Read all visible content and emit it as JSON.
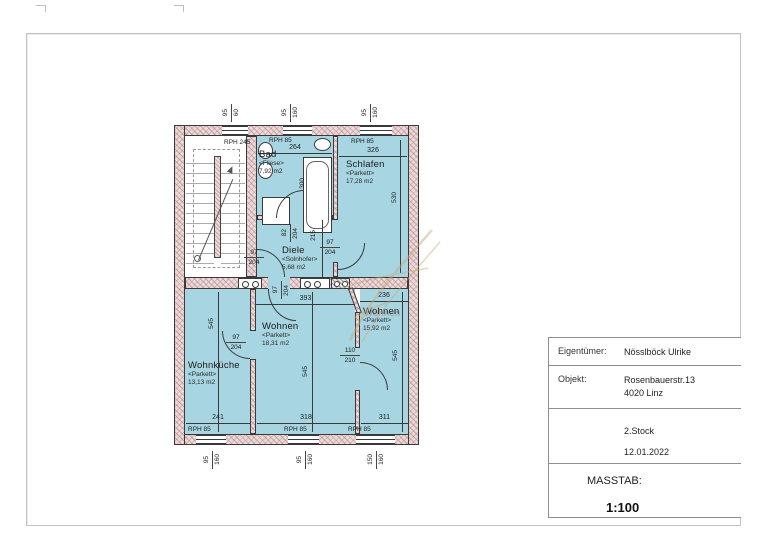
{
  "plan": {
    "rooms": {
      "bad": {
        "name": "Bad",
        "finish": "<Fliese>",
        "area": "7,92 m2"
      },
      "schlafen": {
        "name": "Schlafen",
        "finish": "<Parkett>",
        "area": "17,28 m2"
      },
      "diele": {
        "name": "Diele",
        "finish": "<Solnhofer>",
        "area": "5,68 m2"
      },
      "wohnen": {
        "name": "Wohnen",
        "finish": "<Parkett>",
        "area": "18,31 m2"
      },
      "wohnen2": {
        "name": "Wohnen",
        "finish": "<Parkett>",
        "area": "15,92 m2"
      },
      "wohnkueche": {
        "name": "Wohnküche",
        "finish": "<Parkett>",
        "area": "13,13 m2"
      }
    },
    "rph": {
      "stair": "RPH 245",
      "std": "RPH 85"
    },
    "dims": {
      "bad_w": "264",
      "schlafen_w": "326",
      "schlafen_h": "530",
      "tub_l": "300",
      "diele_h": "215",
      "wohnen_top": "393",
      "wohnen2_top": "236",
      "room_h": "545",
      "kueche_b": "241",
      "wohnen_b": "318",
      "wohnen2_b": "311",
      "door_w": "97",
      "door_h": "204",
      "bad_door_w": "82",
      "wz_door_w": "110",
      "wz_door_h": "210",
      "win_w": "95",
      "win_h_stair": "60",
      "win_h": "160",
      "win_w_big": "150"
    }
  },
  "title_block": {
    "owner_label": "Eigentümer:",
    "owner": "Nösslböck Ulrike",
    "object_label": "Objekt:",
    "object_street": "Rosenbauerstr.13",
    "object_city": "4020 Linz",
    "floor": "2.Stock",
    "date": "12.01.2022",
    "scale_label": "MASSTAB:",
    "scale": "1:100"
  },
  "colors": {
    "room_fill": "#a8d5e2",
    "wall_fill": "#ecd9d9",
    "ink": "#3a3a3a",
    "watermark": "#c8a878"
  }
}
